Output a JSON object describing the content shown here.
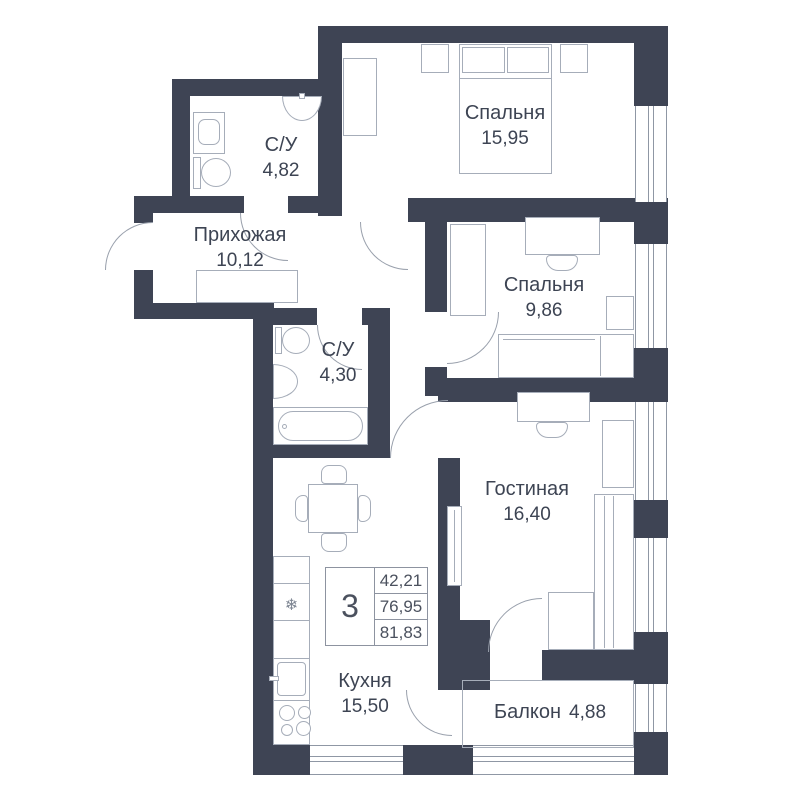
{
  "rooms": {
    "bath1": {
      "name": "С/У",
      "area": "4,82"
    },
    "bedroom1": {
      "name": "Спальня",
      "area": "15,95"
    },
    "hall": {
      "name": "Прихожая",
      "area": "10,12"
    },
    "bath2": {
      "name": "С/У",
      "area": "4,30"
    },
    "bedroom2": {
      "name": "Спальня",
      "area": "9,86"
    },
    "living": {
      "name": "Гостиная",
      "area": "16,40"
    },
    "kitchen": {
      "name": "Кухня",
      "area": "15,50"
    },
    "balcony": {
      "name": "Балкон",
      "area": "4,88"
    }
  },
  "stats": {
    "room_count": "3",
    "areas": [
      "42,21",
      "76,95",
      "81,83"
    ]
  },
  "icons": {
    "fridge_snowflake": "❄"
  },
  "colors": {
    "wall": "#3e4454",
    "furniture_line": "#a6adb9",
    "text": "#3d4453"
  }
}
